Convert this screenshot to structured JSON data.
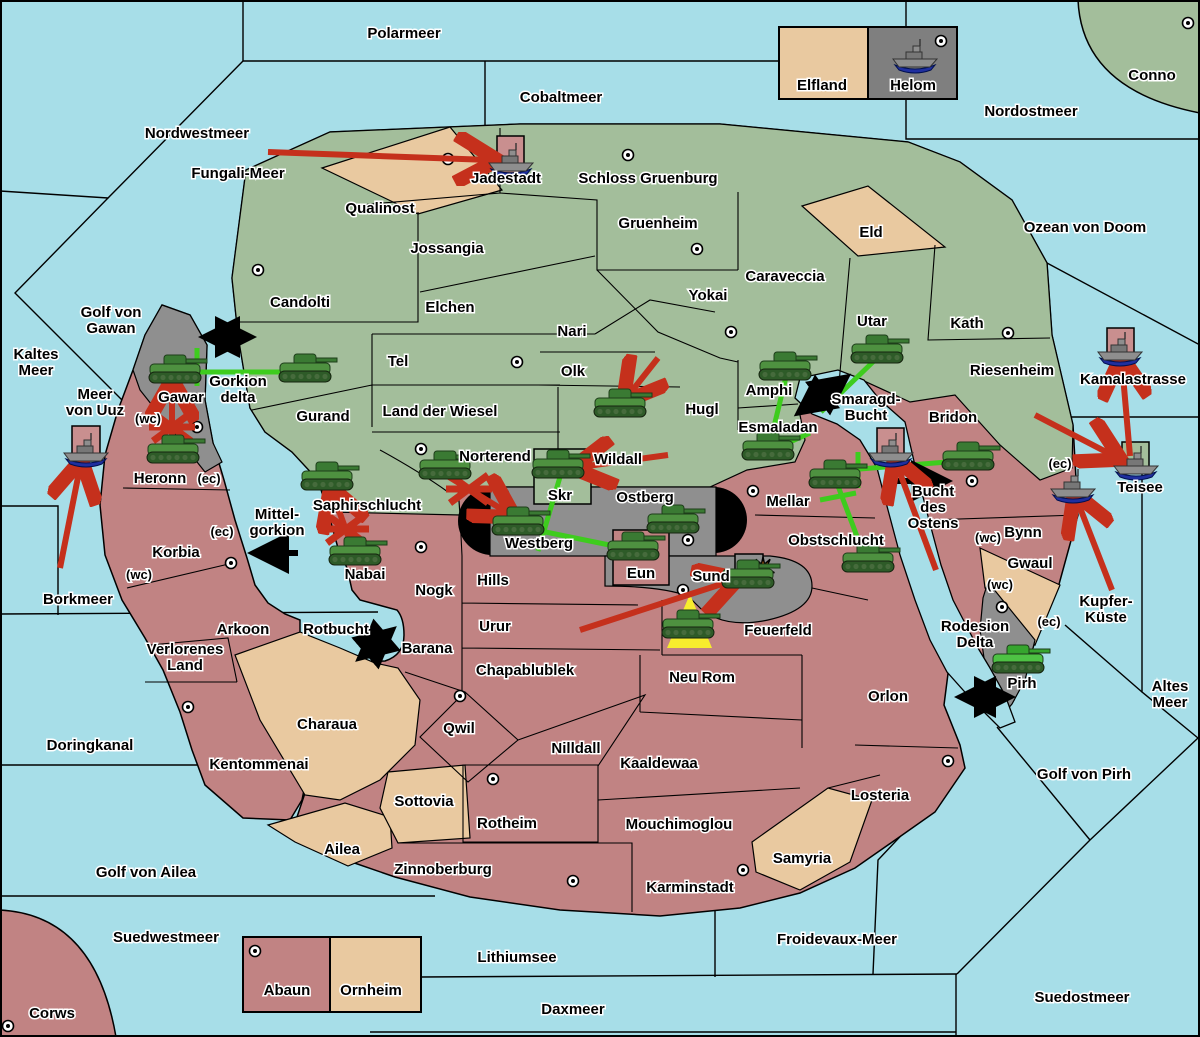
{
  "map": {
    "title": "Fantasy diplomacy war map",
    "width": 1200,
    "height": 1037,
    "colors": {
      "sea": "#A7DEE8",
      "land_green": "#A3BE9B",
      "land_tan": "#E9C9A0",
      "land_red": "#C18383",
      "land_gray": "#8F8F8F",
      "black": "#000000",
      "attack_red": "#C5301C",
      "support_green": "#3ECC1E",
      "dislodged_pink": "#C98F8F",
      "beam_yellow": "#F7ED2E",
      "explosion_orange": "#FF8318"
    }
  },
  "sea_labels": [
    {
      "text": "Polarmeer",
      "x": 404,
      "y": 38
    },
    {
      "text": "Cobaltmeer",
      "x": 561,
      "y": 102
    },
    {
      "text": "Nordwestmeer",
      "x": 197,
      "y": 138
    },
    {
      "text": "Fungali-Meer",
      "x": 238,
      "y": 178
    },
    {
      "text": "Nordostmeer",
      "x": 1031,
      "y": 116
    },
    {
      "text": "Ozean von Doom",
      "x": 1085,
      "y": 232
    },
    {
      "text": "Kaltes Meer",
      "x": 36,
      "y": 367,
      "lines": [
        "Kaltes",
        "Meer"
      ]
    },
    {
      "text": "Golf von Gawan",
      "x": 111,
      "y": 325,
      "lines": [
        "Golf von",
        "Gawan"
      ]
    },
    {
      "text": "Meer von Uuz",
      "x": 95,
      "y": 407,
      "lines": [
        "Meer",
        "von Uuz"
      ]
    },
    {
      "text": "Borkmeer",
      "x": 78,
      "y": 604
    },
    {
      "text": "Gorkion delta",
      "x": 238,
      "y": 394,
      "lines": [
        "Gorkion",
        "delta"
      ]
    },
    {
      "text": "Mittel-gorkion",
      "x": 277,
      "y": 527,
      "lines": [
        "Mittel-",
        "gorkion"
      ]
    },
    {
      "text": "Rotbucht",
      "x": 336,
      "y": 634
    },
    {
      "text": "Smaragd-Bucht",
      "x": 866,
      "y": 412,
      "lines": [
        "Smaragd-",
        "Bucht"
      ]
    },
    {
      "text": "Bucht des Ostens",
      "x": 933,
      "y": 512,
      "lines": [
        "Bucht",
        "des",
        "Ostens"
      ]
    },
    {
      "text": "Kamalastrasse",
      "x": 1133,
      "y": 384
    },
    {
      "text": "Teisee",
      "x": 1140,
      "y": 492
    },
    {
      "text": "Kupfer-Küste",
      "x": 1106,
      "y": 614,
      "lines": [
        "Kupfer-",
        "Küste"
      ]
    },
    {
      "text": "Altes Meer",
      "x": 1170,
      "y": 699,
      "lines": [
        "Altes",
        "Meer"
      ]
    },
    {
      "text": "Golf von Pirh",
      "x": 1084,
      "y": 779
    },
    {
      "text": "Rodesion Delta",
      "x": 975,
      "y": 639,
      "lines": [
        "Rodesion",
        "Delta"
      ]
    },
    {
      "text": "Doringkanal",
      "x": 90,
      "y": 750
    },
    {
      "text": "Golf von Ailea",
      "x": 146,
      "y": 877
    },
    {
      "text": "Suedwestmeer",
      "x": 166,
      "y": 942
    },
    {
      "text": "Lithiumsee",
      "x": 517,
      "y": 962
    },
    {
      "text": "Daxmeer",
      "x": 573,
      "y": 1014
    },
    {
      "text": "Froidevaux-Meer",
      "x": 837,
      "y": 944
    },
    {
      "text": "Suedostmeer",
      "x": 1082,
      "y": 1002
    }
  ],
  "land_labels": [
    {
      "text": "Jadestadt",
      "x": 506,
      "y": 183
    },
    {
      "text": "Schloss Gruenburg",
      "x": 648,
      "y": 183
    },
    {
      "text": "Qualinost",
      "x": 380,
      "y": 213
    },
    {
      "text": "Jossangia",
      "x": 447,
      "y": 253
    },
    {
      "text": "Candolti",
      "x": 300,
      "y": 307
    },
    {
      "text": "Elchen",
      "x": 450,
      "y": 312
    },
    {
      "text": "Nari",
      "x": 572,
      "y": 336
    },
    {
      "text": "Tel",
      "x": 398,
      "y": 366
    },
    {
      "text": "Olk",
      "x": 573,
      "y": 376
    },
    {
      "text": "Gurand",
      "x": 323,
      "y": 421
    },
    {
      "text": "Land der Wiesel",
      "x": 440,
      "y": 416
    },
    {
      "text": "Gruenheim",
      "x": 658,
      "y": 228
    },
    {
      "text": "Yokai",
      "x": 708,
      "y": 300
    },
    {
      "text": "Caraveccia",
      "x": 785,
      "y": 281
    },
    {
      "text": "Eld",
      "x": 871,
      "y": 237
    },
    {
      "text": "Utar",
      "x": 872,
      "y": 326
    },
    {
      "text": "Kath",
      "x": 967,
      "y": 328
    },
    {
      "text": "Riesenheim",
      "x": 1012,
      "y": 375
    },
    {
      "text": "Hugl",
      "x": 702,
      "y": 414
    },
    {
      "text": "Amphi",
      "x": 769,
      "y": 395
    },
    {
      "text": "Esmaladan",
      "x": 778,
      "y": 432
    },
    {
      "text": "Norterend",
      "x": 495,
      "y": 461
    },
    {
      "text": "Wildall",
      "x": 618,
      "y": 464
    },
    {
      "text": "Skr",
      "x": 560,
      "y": 500
    },
    {
      "text": "Ostberg",
      "x": 645,
      "y": 502
    },
    {
      "text": "Westberg",
      "x": 539,
      "y": 548
    },
    {
      "text": "Saphirschlucht",
      "x": 367,
      "y": 510
    },
    {
      "text": "Gawar",
      "x": 181,
      "y": 402
    },
    {
      "text": "Heronn",
      "x": 160,
      "y": 483
    },
    {
      "text": "Korbia",
      "x": 176,
      "y": 557
    },
    {
      "text": "Nabai",
      "x": 365,
      "y": 579
    },
    {
      "text": "Mellar",
      "x": 788,
      "y": 506
    },
    {
      "text": "Obstschlucht",
      "x": 836,
      "y": 545
    },
    {
      "text": "Bridon",
      "x": 953,
      "y": 422
    },
    {
      "text": "Bynn",
      "x": 1023,
      "y": 537
    },
    {
      "text": "Gwaul",
      "x": 1030,
      "y": 568
    },
    {
      "text": "Pirh",
      "x": 1022,
      "y": 688
    },
    {
      "text": "Hills",
      "x": 493,
      "y": 585
    },
    {
      "text": "Nogk",
      "x": 434,
      "y": 595
    },
    {
      "text": "Urur",
      "x": 495,
      "y": 631
    },
    {
      "text": "Barana",
      "x": 427,
      "y": 653
    },
    {
      "text": "Chapablublek",
      "x": 525,
      "y": 675
    },
    {
      "text": "Qwil",
      "x": 459,
      "y": 733
    },
    {
      "text": "Neu Rom",
      "x": 702,
      "y": 682
    },
    {
      "text": "Feuerfeld",
      "x": 778,
      "y": 635
    },
    {
      "text": "Sund",
      "x": 711,
      "y": 581
    },
    {
      "text": "Eun",
      "x": 641,
      "y": 578
    },
    {
      "text": "Orlon",
      "x": 888,
      "y": 701
    },
    {
      "text": "Nilldall",
      "x": 576,
      "y": 753
    },
    {
      "text": "Kaaldewaa",
      "x": 659,
      "y": 768
    },
    {
      "text": "Rotheim",
      "x": 507,
      "y": 828
    },
    {
      "text": "Mouchimoglou",
      "x": 679,
      "y": 829
    },
    {
      "text": "Losteria",
      "x": 880,
      "y": 800
    },
    {
      "text": "Zinnoberburg",
      "x": 443,
      "y": 874
    },
    {
      "text": "Karminstadt",
      "x": 690,
      "y": 892
    },
    {
      "text": "Samyria",
      "x": 802,
      "y": 863
    },
    {
      "text": "Verlorenes Land",
      "x": 185,
      "y": 662,
      "lines": [
        "Verlorenes",
        "Land"
      ]
    },
    {
      "text": "Arkoon",
      "x": 243,
      "y": 634
    },
    {
      "text": "Kentommenai",
      "x": 259,
      "y": 769
    },
    {
      "text": "Charaua",
      "x": 327,
      "y": 729
    },
    {
      "text": "Ailea",
      "x": 342,
      "y": 854
    },
    {
      "text": "Sottovia",
      "x": 424,
      "y": 806
    },
    {
      "text": "Elfland",
      "x": 822,
      "y": 90
    },
    {
      "text": "Helom",
      "x": 913,
      "y": 90
    },
    {
      "text": "Abaun",
      "x": 287,
      "y": 995
    },
    {
      "text": "Ornheim",
      "x": 371,
      "y": 995
    },
    {
      "text": "Conno",
      "x": 1152,
      "y": 80
    },
    {
      "text": "Corws",
      "x": 52,
      "y": 1018
    }
  ],
  "coast_labels": [
    {
      "text": "(wc)",
      "x": 148,
      "y": 423
    },
    {
      "text": "(ec)",
      "x": 209,
      "y": 483
    },
    {
      "text": "(ec)",
      "x": 222,
      "y": 536
    },
    {
      "text": "(wc)",
      "x": 139,
      "y": 579
    },
    {
      "text": "(ec)",
      "x": 1060,
      "y": 468
    },
    {
      "text": "(wc)",
      "x": 988,
      "y": 542
    },
    {
      "text": "(wc)",
      "x": 1000,
      "y": 589
    },
    {
      "text": "(ec)",
      "x": 1049,
      "y": 626
    }
  ],
  "supply_centers": [
    [
      448,
      159
    ],
    [
      628,
      155
    ],
    [
      941,
      41
    ],
    [
      1188,
      23
    ],
    [
      258,
      270
    ],
    [
      517,
      362
    ],
    [
      697,
      249
    ],
    [
      731,
      332
    ],
    [
      421,
      449
    ],
    [
      503,
      494
    ],
    [
      688,
      540
    ],
    [
      683,
      590
    ],
    [
      753,
      491
    ],
    [
      197,
      427
    ],
    [
      231,
      563
    ],
    [
      188,
      707
    ],
    [
      421,
      547
    ],
    [
      460,
      696
    ],
    [
      493,
      779
    ],
    [
      573,
      881
    ],
    [
      743,
      870
    ],
    [
      8,
      1026
    ],
    [
      255,
      951
    ],
    [
      948,
      761
    ],
    [
      972,
      481
    ],
    [
      1008,
      333
    ],
    [
      1002,
      607
    ]
  ],
  "unit_boxes": [
    {
      "x": 497,
      "y": 136,
      "w": 27,
      "h": 37,
      "fill": "pink"
    },
    {
      "x": 72,
      "y": 426,
      "w": 28,
      "h": 35,
      "fill": "pink"
    },
    {
      "x": 877,
      "y": 428,
      "w": 27,
      "h": 32,
      "fill": "pink"
    },
    {
      "x": 1107,
      "y": 328,
      "w": 27,
      "h": 33,
      "fill": "pink"
    },
    {
      "x": 1122,
      "y": 442,
      "w": 27,
      "h": 27,
      "fill": "green"
    }
  ],
  "units": [
    {
      "type": "tank",
      "x": 175,
      "y": 372
    },
    {
      "type": "tank",
      "x": 305,
      "y": 371
    },
    {
      "type": "tank",
      "x": 173,
      "y": 452
    },
    {
      "type": "tank",
      "x": 327,
      "y": 479
    },
    {
      "type": "tank",
      "x": 355,
      "y": 554
    },
    {
      "type": "tank",
      "x": 445,
      "y": 468
    },
    {
      "type": "tank",
      "x": 558,
      "y": 467
    },
    {
      "type": "tank",
      "x": 518,
      "y": 524
    },
    {
      "type": "tank",
      "x": 620,
      "y": 406
    },
    {
      "type": "tank",
      "x": 785,
      "y": 369
    },
    {
      "type": "tank",
      "x": 768,
      "y": 449
    },
    {
      "type": "tank",
      "x": 877,
      "y": 352
    },
    {
      "type": "tank",
      "x": 835,
      "y": 477
    },
    {
      "type": "tank",
      "x": 868,
      "y": 561
    },
    {
      "type": "tank",
      "x": 673,
      "y": 522
    },
    {
      "type": "tank",
      "x": 633,
      "y": 549
    },
    {
      "type": "tank",
      "x": 748,
      "y": 577
    },
    {
      "type": "tank",
      "x": 688,
      "y": 627
    },
    {
      "type": "tank",
      "x": 968,
      "y": 459
    },
    {
      "type": "tank",
      "x": 1018,
      "y": 662,
      "variant": "bright"
    },
    {
      "type": "ship",
      "x": 511,
      "y": 160
    },
    {
      "type": "ship",
      "x": 915,
      "y": 56
    },
    {
      "type": "ship",
      "x": 86,
      "y": 450
    },
    {
      "type": "ship",
      "x": 891,
      "y": 450
    },
    {
      "type": "ship",
      "x": 1120,
      "y": 349
    },
    {
      "type": "ship",
      "x": 1136,
      "y": 463
    },
    {
      "type": "ship",
      "x": 1073,
      "y": 486
    }
  ],
  "red_arrows": [
    [
      268,
      152,
      490,
      160
    ],
    [
      60,
      568,
      80,
      467
    ],
    [
      172,
      447,
      172,
      387
    ],
    [
      352,
      547,
      333,
      494
    ],
    [
      449,
      477,
      508,
      513
    ],
    [
      668,
      455,
      580,
      467
    ],
    [
      658,
      358,
      628,
      396
    ],
    [
      580,
      630,
      731,
      581
    ],
    [
      936,
      570,
      897,
      465
    ],
    [
      1035,
      415,
      1114,
      456
    ],
    [
      1130,
      456,
      1122,
      364
    ],
    [
      1112,
      590,
      1077,
      500
    ]
  ],
  "x_marks": [
    [
      172,
      427
    ],
    [
      346,
      529
    ],
    [
      469,
      489
    ]
  ],
  "black_arrows_double": [
    [
      207,
      337,
      248,
      337
    ],
    [
      801,
      411,
      844,
      379
    ],
    [
      362,
      656,
      390,
      632
    ],
    [
      963,
      697,
      1007,
      697
    ]
  ],
  "black_arrows_single": [
    [
      888,
      481,
      944,
      481
    ],
    [
      298,
      553,
      256,
      553
    ]
  ],
  "green_lines": [
    [
      188,
      372,
      300,
      372
    ],
    [
      197,
      348,
      197,
      386
    ],
    [
      560,
      477,
      538,
      551
    ],
    [
      521,
      527,
      629,
      549
    ],
    [
      786,
      377,
      770,
      443
    ],
    [
      770,
      451,
      810,
      433
    ],
    [
      876,
      359,
      821,
      412
    ],
    [
      838,
      486,
      864,
      555
    ],
    [
      820,
      500,
      856,
      493
    ],
    [
      847,
      470,
      960,
      461
    ],
    [
      858,
      452,
      858,
      488
    ]
  ],
  "explosion": {
    "x": 763,
    "y": 569
  },
  "beam": {
    "points": "690,594 712,648 667,648"
  },
  "special_boxes": {
    "skr": {
      "x": 534,
      "y": 449,
      "w": 57,
      "h": 55
    },
    "eun": {
      "x": 613,
      "y": 530,
      "w": 56,
      "h": 55
    },
    "sund": {
      "x": 735,
      "y": 554,
      "w": 28,
      "h": 25
    }
  },
  "legend_boxes": {
    "elfland_helom": {
      "x": 779,
      "y": 27,
      "w": 178,
      "h": 72,
      "divider": 868
    },
    "abaun_ornheim": {
      "x": 243,
      "y": 937,
      "w": 178,
      "h": 75,
      "divider": 330
    }
  }
}
